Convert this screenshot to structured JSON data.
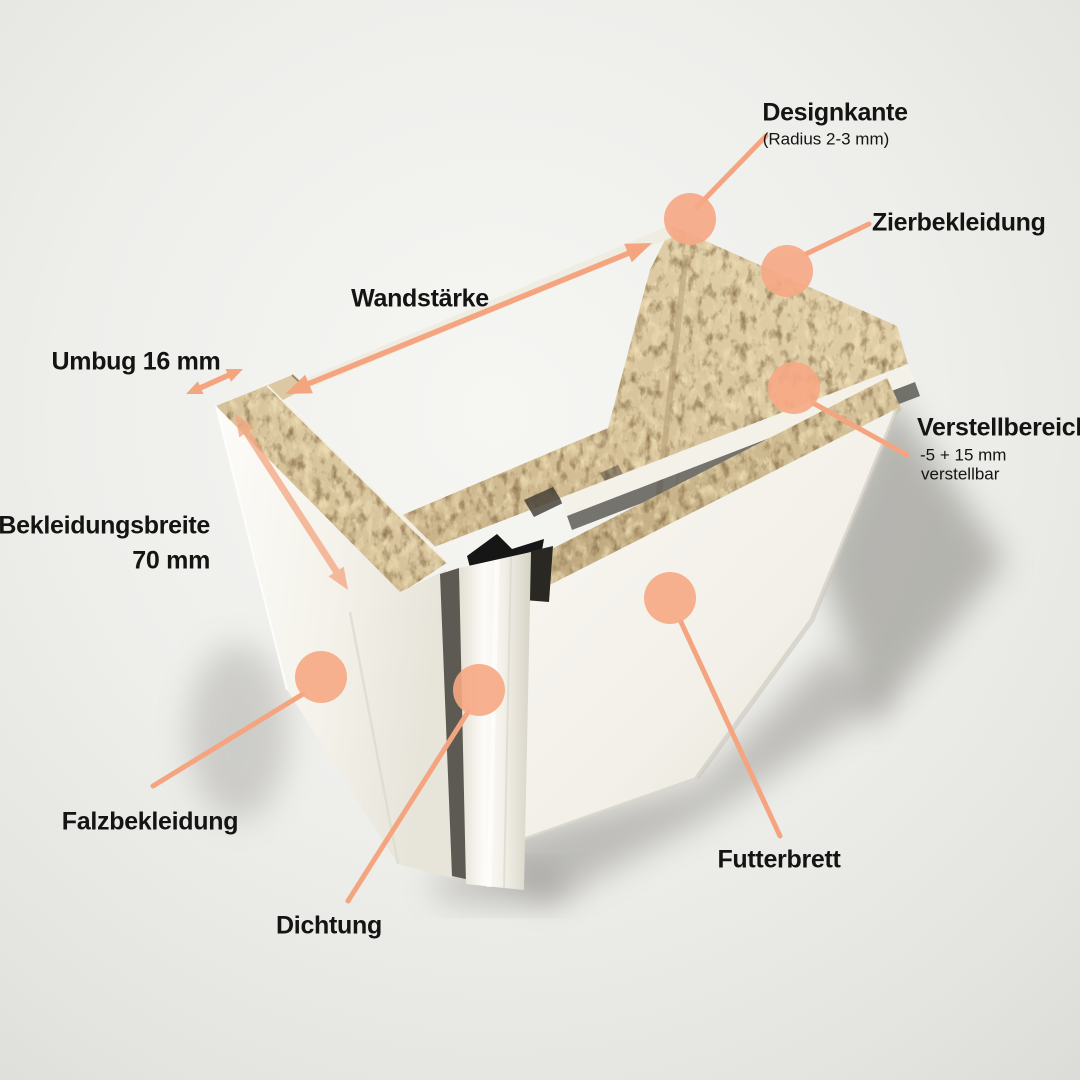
{
  "diagram": {
    "subject": "door-frame-corner-cross-section",
    "colors": {
      "accent_circle": "#F7A884",
      "annotation_line": "#F4A580",
      "text": "#141414",
      "chipboard": "#D6C096",
      "panel_white": "#F8F6F0",
      "background_mid": "#E3E3DF"
    },
    "labels": {
      "designkante": "Designkante",
      "designkante_sub": "(Radius 2-3 mm)",
      "zierbekleidung": "Zierbekleidung",
      "wandstaerke": "Wandstärke",
      "umbug": "Umbug 16 mm",
      "bekleidungsbreite_line1": "Bekleidungsbreite",
      "bekleidungsbreite_line2": "70 mm",
      "verstellbereich": "Verstellbereich",
      "verstellbereich_sub1": "-5 + 15 mm",
      "verstellbereich_sub2": "verstellbar",
      "falzbekleidung": "Falzbekleidung",
      "dichtung": "Dichtung",
      "futterbrett": "Futterbrett"
    }
  }
}
